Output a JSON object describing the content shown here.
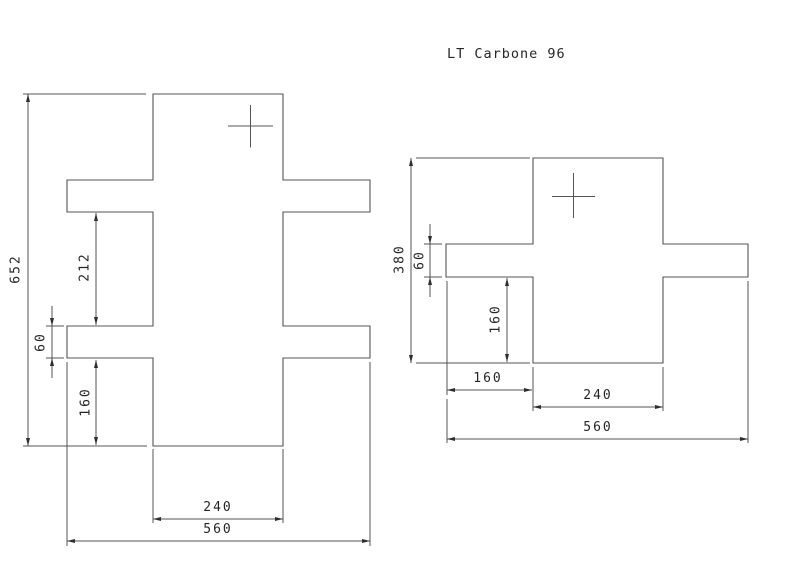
{
  "title": "LT Carbone 96",
  "colors": {
    "background": "#ffffff",
    "line": "#555555",
    "text": "#262626",
    "arrow": "#2e2e2e"
  },
  "figures": [
    {
      "id": "part-view-left",
      "outline_path": "M153,94 H283 V180 H370 V212 H283 V326 H370 V358 H283 V446 H153 V358 H67 V326 H153 V212 H67 V180 H153 Z",
      "cross": {
        "h": [
          228,
          126,
          273,
          126
        ],
        "v": [
          250.5,
          105,
          250.5,
          147.5
        ]
      },
      "dims": [
        {
          "id": "dim-overall-height-652",
          "label": "652",
          "value": 652,
          "orient": "v",
          "x": 28,
          "y1": 94,
          "y2": 446,
          "arrows": "inside",
          "label_x": 16,
          "label_y": 269,
          "ext": [
            [
              23,
              94,
              146,
              94
            ],
            [
              23,
              446,
              147,
              446
            ]
          ]
        },
        {
          "id": "dim-arm-gap-212",
          "label": "212",
          "value": 212,
          "orient": "v",
          "x": 96,
          "y1": 213,
          "y2": 325,
          "arrows": "inside",
          "label_x": 85,
          "label_y": 267,
          "ext": []
        },
        {
          "id": "dim-arm-thickness-60",
          "label": "60",
          "value": 60,
          "orient": "v",
          "x": 52,
          "y1": 326,
          "y2": 358,
          "arrows": "outside",
          "label_x": 41,
          "label_y": 342,
          "ext": [
            [
              46,
              326,
              64,
              326
            ],
            [
              46,
              358,
              64,
              358
            ]
          ]
        },
        {
          "id": "dim-bottom-leg-160",
          "label": "160",
          "value": 160,
          "orient": "v",
          "x": 96,
          "y1": 360,
          "y2": 445,
          "arrows": "inside",
          "label_x": 86,
          "label_y": 402,
          "ext": []
        },
        {
          "id": "dim-bar-width-240",
          "label": "240",
          "value": 240,
          "orient": "h",
          "y": 519,
          "x1": 153,
          "x2": 283,
          "arrows": "inside",
          "label_x": 218,
          "label_y": 511,
          "ext": [
            [
              153,
              449,
              153,
              523
            ],
            [
              283,
              449,
              283,
              523
            ]
          ]
        },
        {
          "id": "dim-overall-width-560",
          "label": "560",
          "value": 560,
          "orient": "h",
          "y": 541,
          "x1": 67,
          "x2": 370,
          "arrows": "inside",
          "label_x": 218,
          "label_y": 533,
          "ext": [
            [
              67,
              362,
              67,
              546
            ],
            [
              370,
              362,
              370,
              546
            ]
          ]
        }
      ]
    },
    {
      "id": "part-view-right",
      "outline_path": "M533,158 H663 V244 H748 V277 H663 V363 H533 V277 H446 V244 H533 Z",
      "cross": {
        "h": [
          552,
          196.5,
          595,
          196.5
        ],
        "v": [
          573.5,
          173,
          573.5,
          218
        ]
      },
      "dims": [
        {
          "id": "dim-overall-height-380",
          "label": "380",
          "value": 380,
          "orient": "v",
          "x": 411,
          "y1": 158,
          "y2": 363,
          "arrows": "inside",
          "label_x": 400,
          "label_y": 259,
          "ext": [
            [
              416,
              158,
              530,
              158
            ],
            [
              416,
              363,
              530,
              363
            ]
          ]
        },
        {
          "id": "dim-arm-thickness-60",
          "label": "60",
          "value": 60,
          "orient": "v",
          "x": 430,
          "y1": 244,
          "y2": 277,
          "arrows": "outside",
          "label_x": 420,
          "label_y": 260,
          "ext": [
            [
              424,
              244,
              442,
              244
            ],
            [
              424,
              277,
              442,
              277
            ]
          ]
        },
        {
          "id": "dim-notch-height-160",
          "label": "160",
          "value": 160,
          "orient": "v",
          "x": 507,
          "y1": 278,
          "y2": 362,
          "arrows": "inside",
          "label_x": 496,
          "label_y": 319,
          "ext": []
        },
        {
          "id": "dim-arm-length-160",
          "label": "160",
          "value": 160,
          "orient": "h",
          "y": 390,
          "x1": 447,
          "x2": 532,
          "arrows": "inside",
          "label_x": 488,
          "label_y": 382,
          "ext": [
            [
              447,
              281,
              447,
              395
            ],
            [
              533,
              367,
              533,
              411
            ]
          ]
        },
        {
          "id": "dim-bar-width-240",
          "label": "240",
          "value": 240,
          "orient": "h",
          "y": 407,
          "x1": 533,
          "x2": 663,
          "arrows": "inside",
          "label_x": 598,
          "label_y": 399,
          "ext": [
            [
              663,
              367,
              663,
              411
            ]
          ]
        },
        {
          "id": "dim-overall-width-560",
          "label": "560",
          "value": 560,
          "orient": "h",
          "y": 439,
          "x1": 447,
          "x2": 748,
          "arrows": "inside",
          "label_x": 598,
          "label_y": 431,
          "ext": [
            [
              447,
              399,
              447,
              443
            ],
            [
              748,
              281,
              748,
              443
            ]
          ]
        }
      ]
    }
  ]
}
